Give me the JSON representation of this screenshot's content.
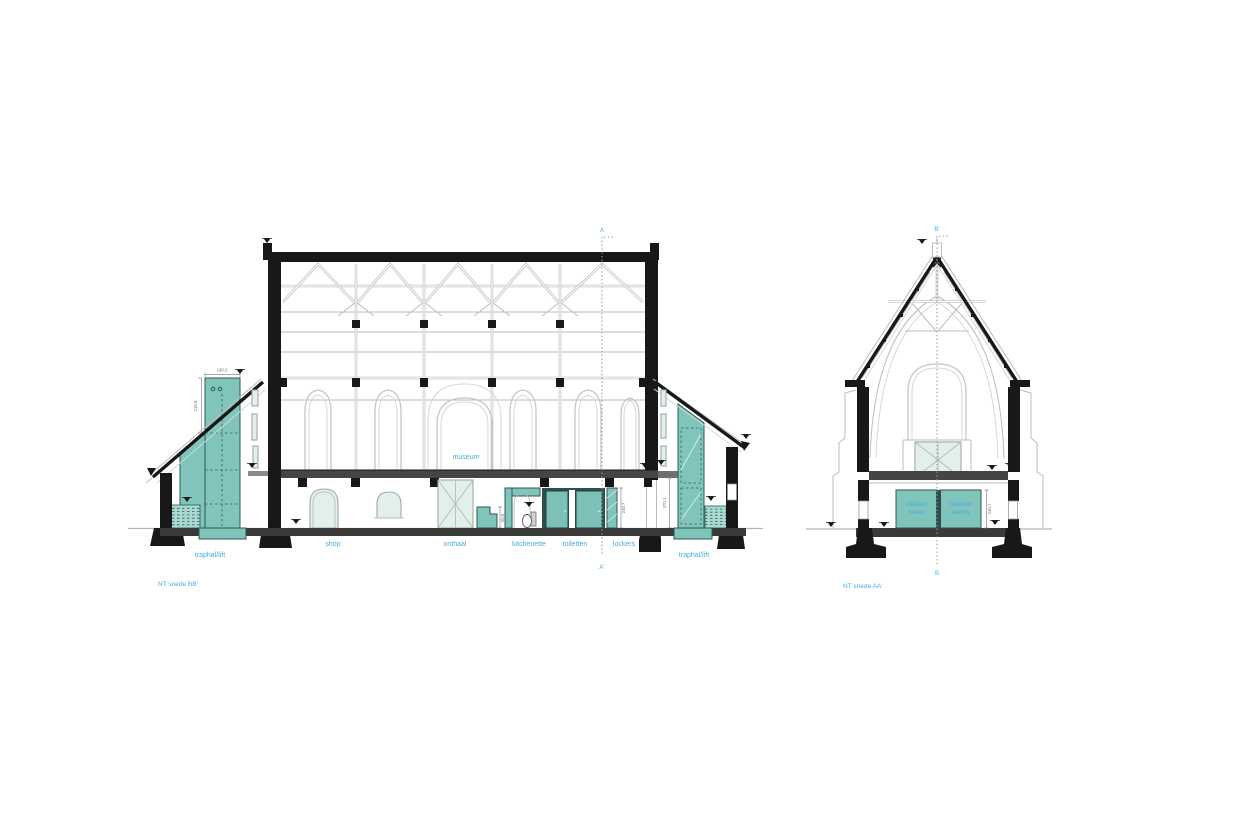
{
  "drawing": {
    "type": "architectural-section",
    "background": "#ffffff",
    "accent_teal": "#80c4bb",
    "label_blue": "#46ade2",
    "line_black": "#181818"
  },
  "section_bb": {
    "caption": "NT snede BB'",
    "cut_line": {
      "top": "A",
      "bottom": "A'"
    },
    "labels": {
      "museum": "museum",
      "shop": "shop",
      "onthaal": "onthaal",
      "kitchenette": "kitchenette",
      "toiletten": "toiletten",
      "lockers": "lockers",
      "traphal_left": "traphal/lift",
      "traphal_right": "traphal/lift"
    },
    "dimensions": {
      "lift_width": "190,0",
      "lift_height": "210,0",
      "counter_height": "90,0",
      "doors_height": "240,7",
      "shaft_height": "370,1"
    }
  },
  "section_aa": {
    "caption": "NT snede AA'",
    "cut_line": {
      "top": "B'",
      "bottom": "B"
    },
    "labels": {
      "toiletten_heren": [
        "toiletten",
        "heren"
      ],
      "toiletten_dames": [
        "toiletten",
        "dames"
      ]
    },
    "dimensions": {
      "room_height": "240,7"
    }
  }
}
